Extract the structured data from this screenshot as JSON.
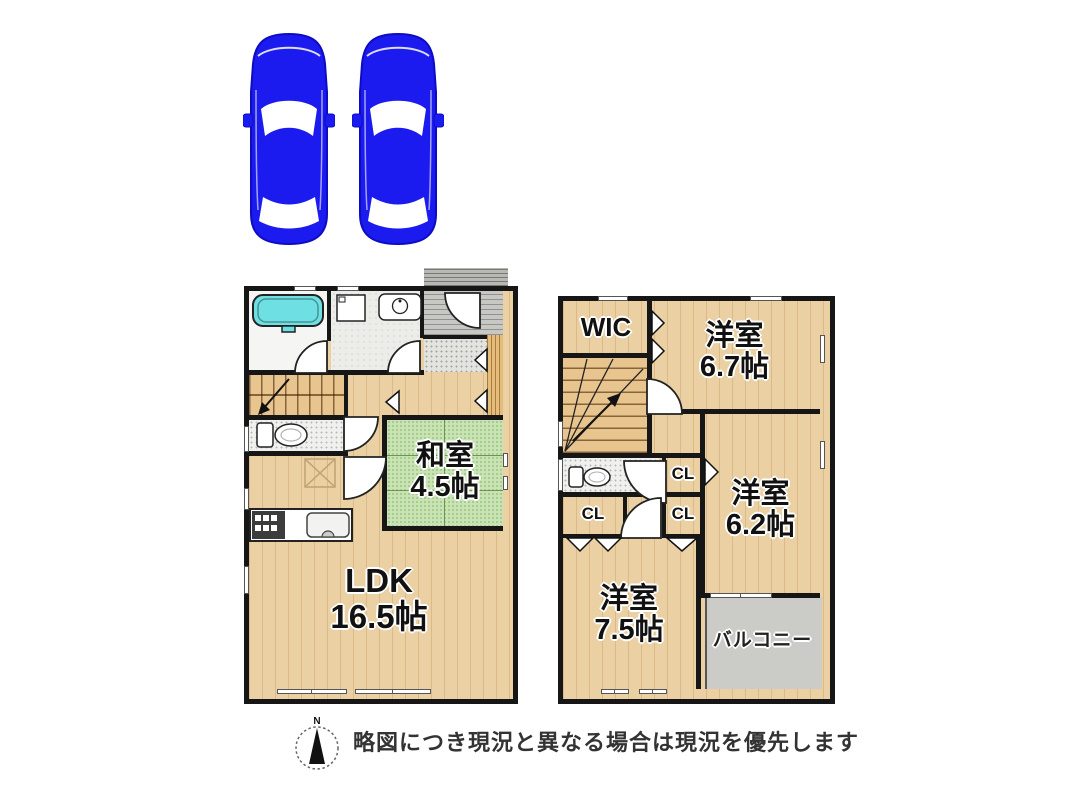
{
  "floor1": {
    "ldk_label": "LDK",
    "ldk_size": "16.5帖",
    "washitsu_label": "和室",
    "washitsu_size": "4.5帖"
  },
  "floor2": {
    "wic_label": "WIC",
    "room67_label": "洋室",
    "room67_size": "6.7帖",
    "room62_label": "洋室",
    "room62_size": "6.2帖",
    "room75_label": "洋室",
    "room75_size": "7.5帖",
    "closet_label": "CL",
    "balcony_label": "バルコニー"
  },
  "footer": {
    "compass_north": "N",
    "disclaimer": "略図につき現況と異なる場合は現況を優先します"
  },
  "colors": {
    "car_blue": "#1b1aef",
    "wall_black": "#161616",
    "wood_floor": "#ead0a2",
    "tatami_green": "#c9e4b3",
    "balcony_gray": "#cbcbc7",
    "bathtub_cyan": "#6ee0e4"
  }
}
